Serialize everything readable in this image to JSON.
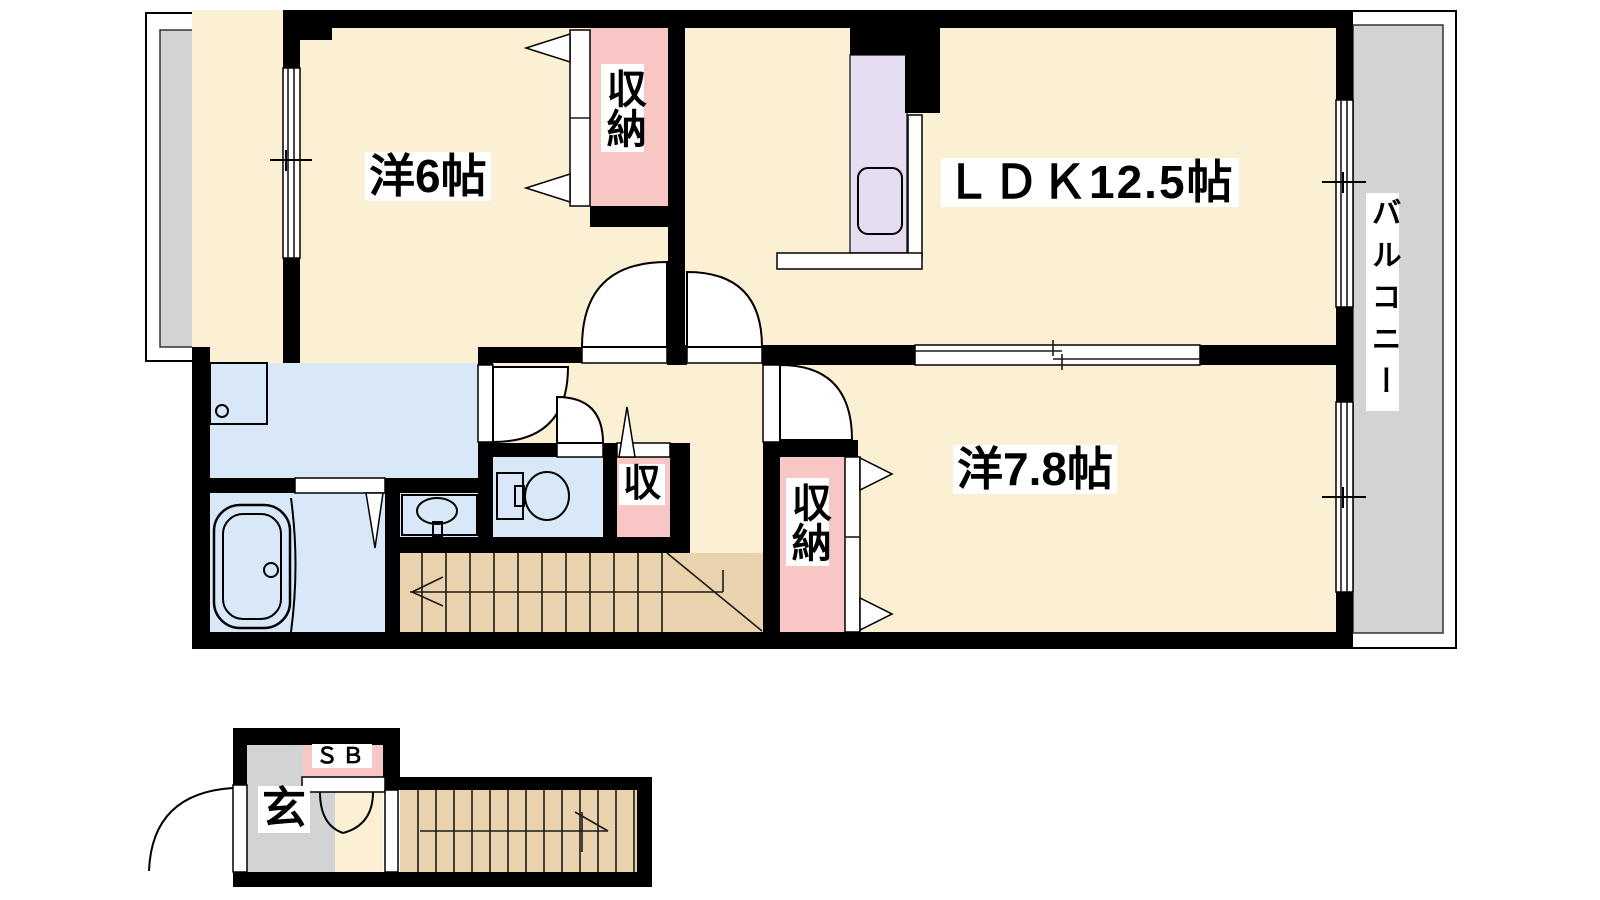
{
  "title": "2LDK apartment floor plan",
  "colors": {
    "wall": "#000000",
    "room": "#FBF0D3",
    "closet": "#F9C6C6",
    "kitchen": "#E6DCF2",
    "water": "#D9E8F8",
    "stairs": "#EAD3AC",
    "balcony": "#D3D3D3"
  },
  "labels": {
    "room1": "洋6帖",
    "ldk": "ＬＤＫ12.5帖",
    "room2": "洋7.8帖",
    "closet_top": "収納",
    "closet_right": "収納",
    "closet_small": "収",
    "balcony": "バルコニー",
    "entrance": "玄",
    "shoe_box": "ＳＢ"
  }
}
